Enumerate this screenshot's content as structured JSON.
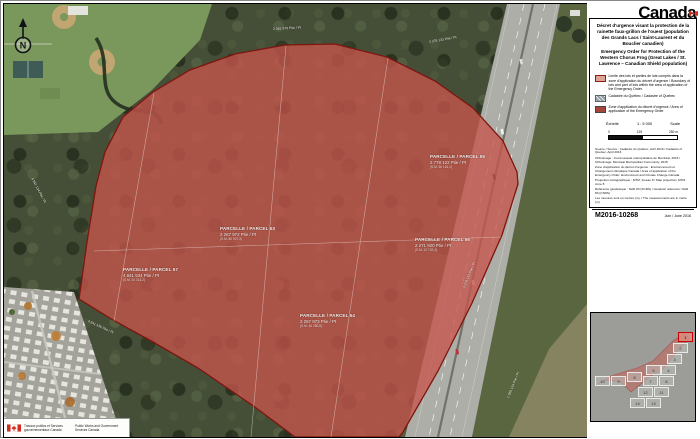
{
  "wordmark": {
    "text": "Canada"
  },
  "panel": {
    "title_fr": "Décret d'urgence visant la protection de la rainette faux-grillon de l'ouest (population des Grands Lacs / Saint-Laurent et du Bouclier canadien)",
    "title_en": "Emergency Order for Protection of the Western Chorus Frog (Great Lakes / St. Lawrence – Canadian Shield population)",
    "legend": [
      {
        "swatch": "boundary-swatch",
        "label": "Limite des lots et parties de lots compris dans la zone d'application du décret d'urgence / Boundary of lots and part of lots within the area of application of the Emergency Order."
      },
      {
        "swatch": "cadastre-swatch",
        "label": "Cadastre du Québec / Cadastre of Quebec"
      },
      {
        "swatch": "zone-swatch",
        "label": "Zone d'application du décret d'urgence / Area of application of the Emergency Order"
      }
    ],
    "scale": {
      "label_fr": "Échelle",
      "ratio": "1 : 5 000",
      "label_en": "Scale",
      "tick_start": "0",
      "tick_mid": "125",
      "tick_end": "250",
      "unit": "m"
    },
    "sources": [
      "Source / Source : Cadastre du Québec, Avril 2016 / Cadastre of Quebec, April 2016",
      "Orthoimage : Communauté métropolitaine de Montréal, 2015 / Orthoimage: Montreal Metropolitan Community, 2015",
      "Zone d'application du décret d'urgence : Environnement et Changement climatique Canada / Area of application of the Emergency Order: Environment and Climate Change Canada",
      "Projection cartographique : MTM, fuseau 8 / Map projection: MTM, zone 8",
      "Référence géodésique : NAD 83 (SCRS) / Geodetic reference: NAD 83 (CSRS)",
      "Les mesures sont en mètres (m). / The measurements are in metre (m)."
    ],
    "map_number": "M2016-10268",
    "date": "Juin / June 2016"
  },
  "map": {
    "north_label": "N",
    "parcels": [
      {
        "title": "PARCELLE / PARCEL 55",
        "lot": "2 778 122 Ptie / Pt",
        "area": "(S.M. 36 161,1)",
        "x": 426,
        "y": 150
      },
      {
        "title": "PARCELLE / PARCEL 53",
        "lot": "2 267 972 Ptie / Pt",
        "area": "(S.M. 80 907,3)",
        "x": 216,
        "y": 222
      },
      {
        "title": "PARCELLE / PARCEL 56",
        "lot": "2 271 920 Ptie / Pt",
        "area": "(S.M. 12 702,4)",
        "x": 411,
        "y": 233
      },
      {
        "title": "PARCELLE / PARCEL 57",
        "lot": "4 841 534 Ptie / Pt",
        "area": "(S.M. 24 314,2)",
        "x": 119,
        "y": 263
      },
      {
        "title": "PARCELLE / PARCEL 54",
        "lot": "2 267 973 Ptie / Pt",
        "area": "(S.M. 46 280,5)",
        "x": 296,
        "y": 309
      }
    ],
    "edge_labels": [
      {
        "text": "2 381 979 Ptie / Pt",
        "x": 269,
        "y": 23,
        "rot": -3
      },
      {
        "text": "3 378 133 Ptie / Pt",
        "x": 425,
        "y": 36,
        "rot": -10
      },
      {
        "text": "4 841 134 Ptie / Pt",
        "x": 28,
        "y": 172,
        "rot": 62
      },
      {
        "text": "4 841 536 Ptie / Pt",
        "x": 84,
        "y": 315,
        "rot": 25
      },
      {
        "text": "3 378 132 Ptie / Pt",
        "x": 460,
        "y": 282,
        "rot": -68
      },
      {
        "text": "1 980 134 Ptie / Pt",
        "x": 504,
        "y": 392,
        "rot": -68
      }
    ]
  },
  "inset": {
    "tiles": [
      {
        "n": "1",
        "x": 87,
        "y": 19,
        "hl": true
      },
      {
        "n": "2",
        "x": 82,
        "y": 30
      },
      {
        "n": "3",
        "x": 76,
        "y": 41
      },
      {
        "n": "5",
        "x": 55,
        "y": 52
      },
      {
        "n": "4",
        "x": 70,
        "y": 52
      },
      {
        "n": "10",
        "x": 4,
        "y": 63
      },
      {
        "n": "9",
        "x": 20,
        "y": 63
      },
      {
        "n": "8",
        "x": 36,
        "y": 59
      },
      {
        "n": "7",
        "x": 52,
        "y": 63
      },
      {
        "n": "6",
        "x": 68,
        "y": 63
      },
      {
        "n": "12",
        "x": 47,
        "y": 74
      },
      {
        "n": "11",
        "x": 63,
        "y": 74
      },
      {
        "n": "14",
        "x": 39,
        "y": 85
      },
      {
        "n": "13",
        "x": 55,
        "y": 85
      }
    ]
  },
  "footer": {
    "fr": "Travaux publics et Services gouvernementaux Canada",
    "en": "Public Works and Government Services Canada"
  },
  "colors": {
    "zone_fill": "#c25a4f",
    "zone_border": "#7e150e",
    "highlight": "#cc0000"
  }
}
